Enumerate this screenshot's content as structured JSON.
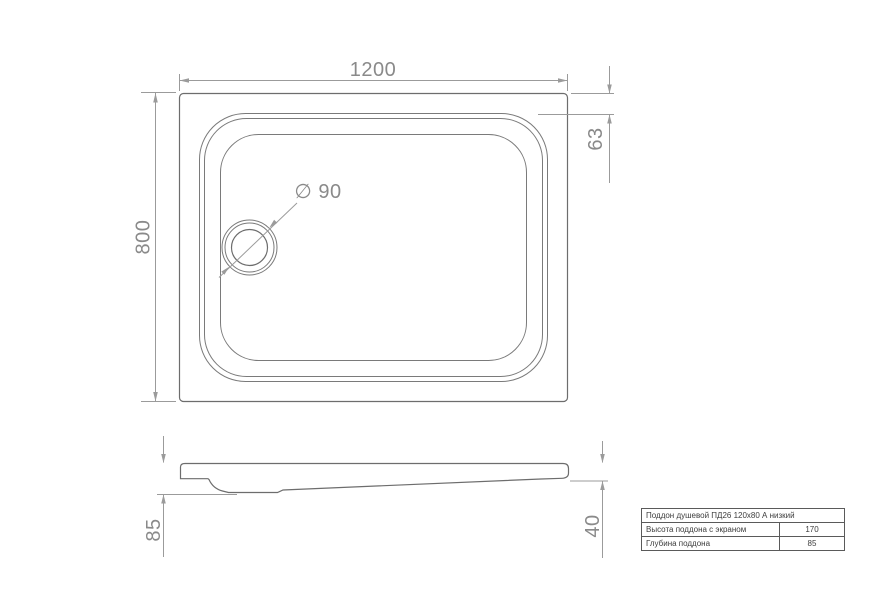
{
  "drawing_title": "Shower tray technical drawing",
  "top_view": {
    "width_dim": "1200",
    "height_dim": "800",
    "rim_inset_dim": "63",
    "drain_diameter_dim": "∅ 90"
  },
  "side_view": {
    "height_dim": "85",
    "edge_height_dim": "40"
  },
  "spec_table": {
    "title": "Поддон душевой ПД26 120x80 А низкий",
    "rows": [
      {
        "label": "Высота поддона с экраном",
        "value": "170"
      },
      {
        "label": "Глубина поддона",
        "value": "85"
      }
    ]
  },
  "colors": {
    "background": "#ffffff",
    "object_line": "#6d6d6d",
    "dimension_line": "#9b9b9b",
    "dimension_text": "#8a8a8a",
    "table_border": "#5a5a5a",
    "table_text": "#3d3d3d"
  }
}
